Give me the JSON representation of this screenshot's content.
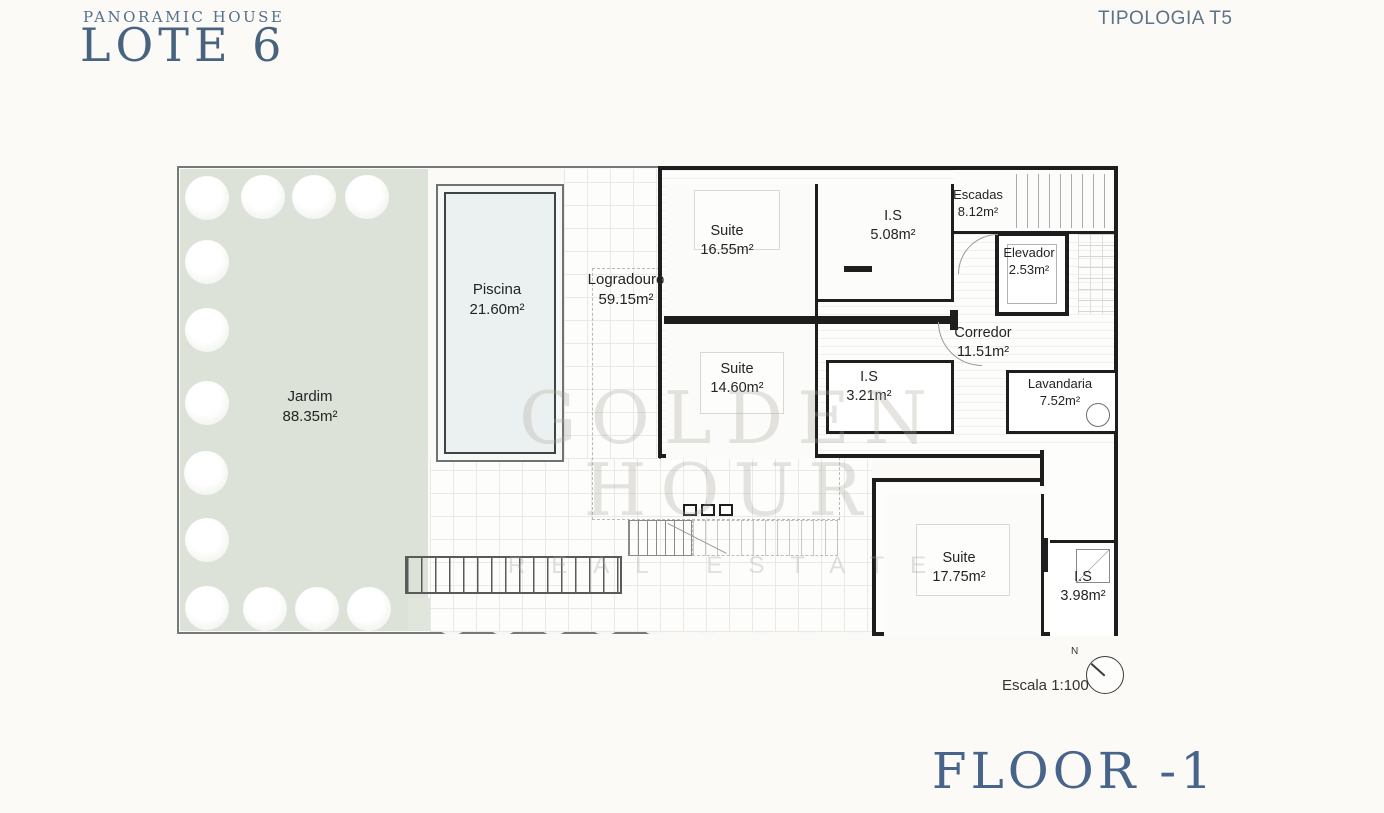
{
  "header": {
    "project_name": "PANORAMIC HOUSE",
    "lot": "LOTE 6",
    "typology": "TIPOLOGIA T5"
  },
  "footer": {
    "floor_label": "FLOOR -1"
  },
  "watermark": {
    "line1": "GOLDEN HOUR",
    "line2": "REAL ESTATE"
  },
  "scale": {
    "label": "Escala 1:100",
    "north": "N"
  },
  "rooms": {
    "jardim": {
      "name": "Jardim",
      "area": "88.35m²"
    },
    "piscina": {
      "name": "Piscina",
      "area": "21.60m²"
    },
    "logradouro": {
      "name": "Logradouro",
      "area": "59.15m²"
    },
    "suite1": {
      "name": "Suite",
      "area": "16.55m²"
    },
    "is1": {
      "name": "I.S",
      "area": "5.08m²"
    },
    "escadas": {
      "name": "Escadas",
      "area": "8.12m²"
    },
    "elevador": {
      "name": "Elevador",
      "area": "2.53m²"
    },
    "corredor": {
      "name": "Corredor",
      "area": "11.51m²"
    },
    "suite2": {
      "name": "Suite",
      "area": "14.60m²"
    },
    "is2": {
      "name": "I.S",
      "area": "3.21m²"
    },
    "lavandaria": {
      "name": "Lavandaria",
      "area": "7.52m²"
    },
    "suite3": {
      "name": "Suite",
      "area": "17.75m²"
    },
    "is3": {
      "name": "I.S",
      "area": "3.98m²"
    }
  },
  "colors": {
    "accent_blue": "#47637f",
    "garden_green": "#dce2d8",
    "pool_blue": "#ebf1f1",
    "wall_black": "#1e1e1e",
    "watermark_gray": "#aaa598"
  }
}
